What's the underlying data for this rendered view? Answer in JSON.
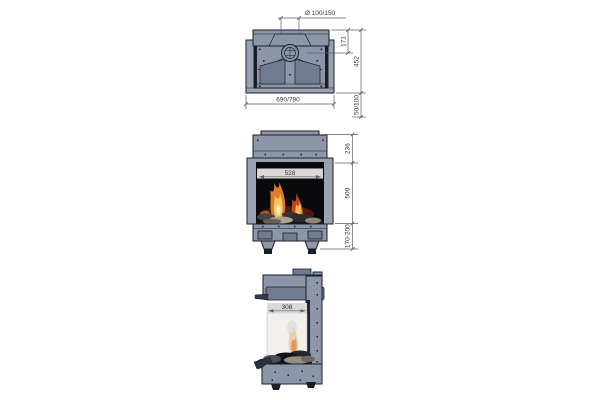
{
  "figure": {
    "kind": "technical dimension drawing",
    "subject": "built-in gas fireplace, three orthographic views (top, front, side)"
  },
  "dims": {
    "flue_diameter": "Ø 100/150",
    "flue_center_depth": "171",
    "total_depth": "452",
    "total_width": "690/790",
    "wall_clearance": "50/100",
    "top_section_height": "236",
    "front_glass_width": "528",
    "glass_height": "500",
    "base_height": "170-200",
    "side_glass_width": "308"
  },
  "colors": {
    "background": "#ffffff",
    "body_fill": "#8d96a8",
    "body_fill_light": "#9aa2b2",
    "body_fill_dark": "#727c90",
    "outline": "#1a1e28",
    "interior": "#0a0a0c",
    "dim_line": "#5a5f66",
    "dim_text": "#33363c",
    "dim_band": "#d9d9d9",
    "flame_orange": "#e07b28",
    "flame_yellow": "#f4c85e",
    "flame_red": "#bf471e",
    "flame_core": "#fbe9c0",
    "glass_side": "#f1f0ed",
    "log_light": "#aaa296",
    "log_dark": "#1c1c20"
  }
}
